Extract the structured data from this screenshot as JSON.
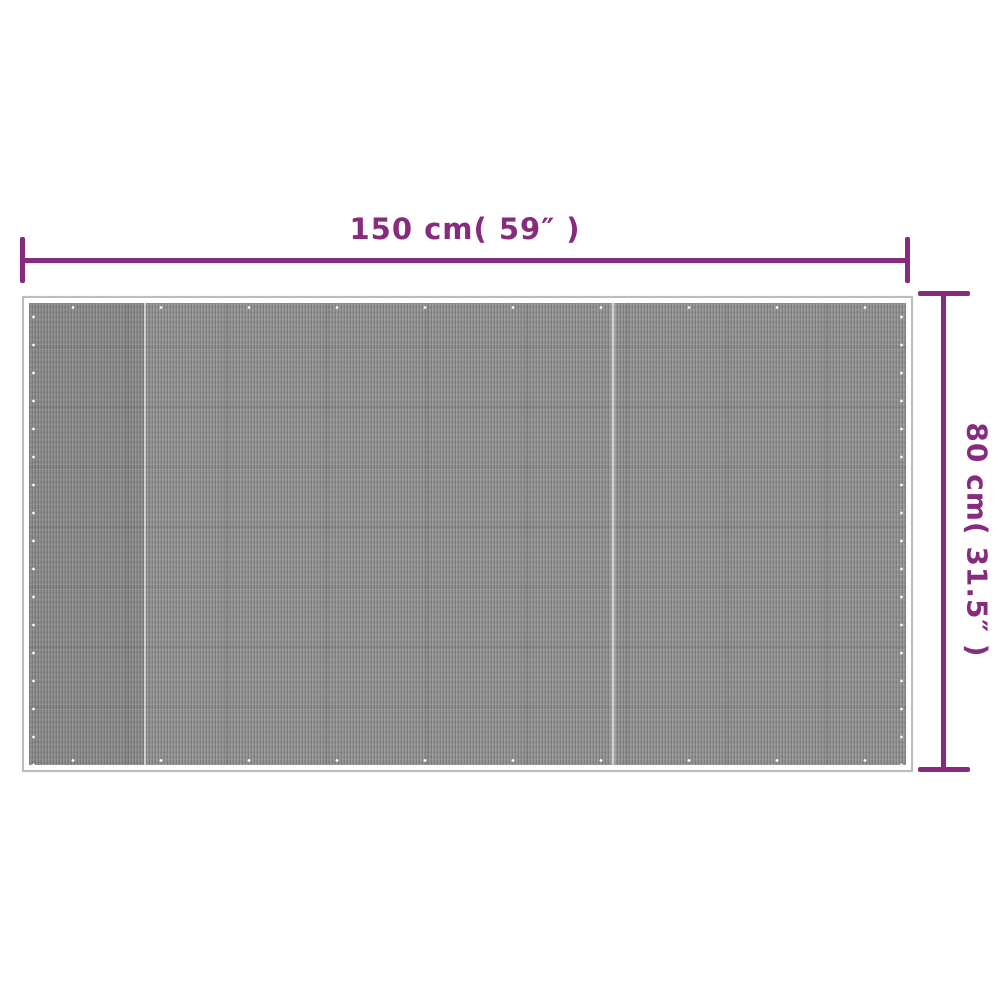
{
  "diagram": {
    "width_dimension": {
      "label": "150 cm( 59″ )"
    },
    "height_dimension": {
      "label": "80 cm( 31.5″ )"
    },
    "product": {
      "name": "gray mesh mat"
    },
    "colors": {
      "accent": "#862B7D",
      "mesh_gray": "#8F8F8F",
      "hem_white": "#FFFFFF",
      "outline_gray": "#BDBDBD"
    }
  }
}
